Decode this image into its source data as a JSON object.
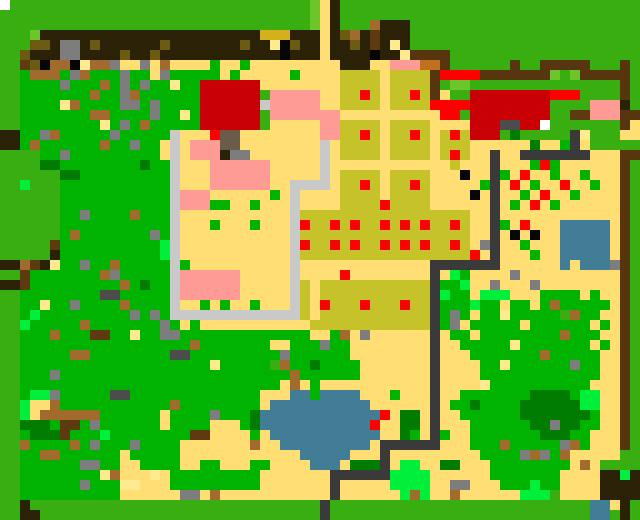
{
  "map": {
    "width_px": 640,
    "height_px": 520,
    "tile_size": 10,
    "cols": 64,
    "rows_count": 52,
    "palette": {
      "G": "#38ae11",
      "g": "#00b300",
      "D": "#007d00",
      "L": "#00ef3a",
      "M": "#6cc629",
      "Y": "#ffdf73",
      "y": "#ffeb8f",
      "O": "#c6c32a",
      "R": "#ff0000",
      "r": "#c80003",
      "P": "#ff9b95",
      "B": "#2b2106",
      "E": "#6b5b10",
      "T": "#d4b01b",
      "b": "#a26b2e",
      "h": "#5e3a10",
      "C": "#c1701f",
      "W": "#57350f",
      "K": "#060606",
      "k": "#3a3a3a",
      "A": "#4c4c4c",
      "S": "#7d7d7d",
      "s": "#c9c9c9",
      "U": "#417e96",
      "N": "#ffffff",
      "u": "#6b5b4b"
    },
    "palette_names": {
      "G": "grass-field",
      "g": "meadow-green",
      "D": "tree-canopy",
      "L": "lime-sprout",
      "M": "light-grass",
      "Y": "sand-dirt",
      "y": "pale-sand",
      "O": "crop-plot",
      "R": "red-crop",
      "r": "red-building",
      "P": "pink-terrace",
      "B": "dark-trunk",
      "E": "dark-olive",
      "T": "gold-tile",
      "b": "dirt-brown",
      "h": "deep-brown",
      "C": "orange-crate",
      "W": "fence-wood",
      "K": "black-tile",
      "k": "dark-trail",
      "A": "dark-stone",
      "S": "stone-gray",
      "s": "path-light",
      "U": "water",
      "N": "spawn-marker",
      "u": "gray-trunk"
    },
    "rows": [
      "NGGGGGGGGGGGGGGGGGGGGGGGGGGGGGGMYBGGGGGGGGGGGGGGGGGGGGGGGGGGGGGG",
      "GGGGGGGGGGGGGGGGGGGGGGGGGGGGGGGMYBGGGGGGGGGGGGGGGGGGGGGGGGGGGGGG",
      "GGGGGGGGGGGGGGGGGGGGGGGGGGGGGGGMYBGGGbBBBGGGGGGGGGGGGGGGGGGGGGGG",
      "GGGMBBBBBBBBBBBBBBBBBBBBBBTTTBBBYBEbBhBBBGGGGGGGGGGGGGGGGGGGGGGG",
      "GGGEEBSSBEBBBBBBEBBBBBBBEBByKEBBYBBEBhByBGGGGGGGGGGGGGGGGGGGGGGG",
      "GGEBBBSSBBBBEBBEBBBBBBBBBBBBKBBBYBBBBKBByWWWWGGGGGGGGGGGGGGGGGGG",
      "GGhEKbbKybbSYYSYbYYYYgYYgYYYYYYYYYBBBYYPPPCCWGGGGGGWGGWWWWWGGGWG",
      "GGgbbbgSbgggSggYSgggggYgYYYYYgYYYYOOOOYOOOOWRRRRWWWWWWWMGMWWWWWG",
      "GGggggSgggbgSgSggyggrrrrrrYYYYYYYYOOOOYOOOOWGMMGGGGGGGGGGGGGGGWG",
      "GGgggggggbggSbggggggrrrrrrGPPPPPYYOOROYOOROWYGGrrrrrrrrRRRGGGGWG",
      "GGggggybggggSSgSggggrrrrrrsPPPPPYYOOOOYOOOORRRRrrrrrrrrGGGGPPPBG",
      "GGgggggggbbggggSggygrrrrrrGPPPPPPPYYYYYYYYYYRRGrrrrrrrrGGhhPPPWW",
      "GGggggggggygSgbgggggrrrrrrGYYYYYPPOOOOYOOOOYYYYrrrAArrNGGGGGGGWY",
      "BBggSbgggggSgggggsYYYRuuYYYYYYYYPPOOROYOOROYOROrrrGDGGGGGkyGGGYY",
      "BBgbggggggbggSggYsYPPPuuYYYYYYYYsYOOOOYOOOOYOOOYYYYYYDYYgkYGGGGG",
      "GGGGggSgggggggggYsYPPPBSSYYYYYYYsYOOOOYOOOOYOROYYkYYkkkkkkkYYYWW",
      "GGGGDDggggggggDggsYYYPPPPPPYYYYYsYYYYYYYYYYYYOYYYkYYYgRgYYYYYYWG",
      "GGGGGGDDgggggggggsYYYPPPPPPYYYYYsYOOOOYOOOOYYYKYYkgYRYYgYYgYYYWG",
      "GGLGGGgggggggggggsYYYPPPPPPYYssssYOOROYOOROYYYYYgkYRYgYYRYYgYYWG",
      "GGGGGGgggggggggggsPPPYYYYYYgYsYYYYOOOOYOOOOYYYYKYkYYgYRYYgYYYYWG",
      "GGGGGGgggggggggggsPPPggYYgYYYsYYYYOOOOROOOOYYYYYYkYgYRYgYYYYYYWG",
      "GGGGGGggSggggbgggsYYYYYYYYYYYsOOOOOOOOOOOOOOOOOYYkYYYYYYYYYYYYWG",
      "GGGGGGgggggggggggsYYYgYYYgYYYsROOROROOROROROOROYYkgYRYYYUUUUUYWG",
      "GGGGGGgbgggggggSgsYYYYYYYYYYYsOOOOOOOOOOOOOOOOOYYkYKYKYYUUUUUYWG",
      "GGGGGhggggggggggLsYYYYYYYYYYYsROOROROOROROROOROYSkYYgYYYUUUUUYWG",
      "GGGGGBggggggggggLsYYYYYYYYYYYsOOOOOOOOOOOOOOOOORYkYYYgYYUUUUUYWG",
      "BBbhByggSggbgggggsgYYYYYYYYYYsYYYYYYYYYYYYYkkkkkkkYYYYYYUYUUUSWG",
      "GGhgggggggbSgggggsPPPPPPYYYYYsYYYYRYYYYYYYYkYLgYYYYSYYYYYYYYYYWG",
      "BBhgggggggggbgDggsPPPPPPYYYYYsOYOOOOOOOOOOOkggLYYSYYYSYYYYYYYYWG",
      "GGggggggggAAgggggsPPPPPPYYYYYsOYOOOOOOOOOOOkLggYLLLYYYggggYgYYWG",
      "GGggyggSggggbggggsYYgYgYYgYYYsOYROOOROOOROOkgggLggYggYgbgggggYWG",
      "GGgLgggggggggSgSgsssssssssssssOYOOOOOOOOOOOkgSgYggygggggగbggYYWG",
      "GGLgggggbgggggggSgYgYYYYYYYYYYYOOOOOOOOOOOOkgSYgggggYggggggYgYWG",
      "GGgggbggghhggyggSSgggggggggggggYYgbYSYYYYYYkYggYggggggggbgggYYWG",
      "GGgggggggggggggggggbgggggggYYgggSggYYYYYYYYkYYgggggygggggggYgYWG",
      "GGgggggbbggggggggAAgggggggggSggggggYYYYYYYYkYYYgggggggbgggggYYWG",
      "GGgggggggggggggggggggygggggגbggDggggYYYYYYYkYYYYggyggggggSggYYWG",
      "GGgggSgggggggggggggggggggggggbggggggYYYYYYYkYYYYggggggggggggYYWG",
      "GGggggggggggggggggggggggggggYbYgYYYYYYYYYYYkYYYYyggggggggggYYYWG",
      "GGgLLSgggggAAgggggggggggggYYYUUgUUUUYYYgYYYkYYgggggggDDDDgLLYYWG",
      "GGLYYbgggggggggggbggggggggYUUUUUUUUUUYYYYYYkYggDggggDDDDDDLLYYWG",
      "GGLYbbbbbbggggggYggggSgggDUUUUUUUUUUUURYDDYkYYggggggDDDDDDDgYYWG",
      "GGDDDghhgSggggggYggggYYYgDUUUUUUUUUUURYYDDYkYYYggggggDDSDDggYYWG",
      "GGgDDDhgggLgggggggghhYYYYgYUUUUUUUUUUUYYDgYkgYYgggggggDDDggYYYWG",
      "GGbggggbgSgggSggggYYYYYYYbYYUUUUUUUUUYkkkkkkYYYgggbgggggSbgYYYWG",
      "GGggbbggggggYgggggYYYYYYYYYYYYUUUUUYYYkYYYYYYYYYggggSbSgbYYYYYGG",
      "GGggggggSSggYYggggYYggYYYggYYYYUUUYDDDkYLLYYDDYYYggggggggYbYGGGG",
      "GGggggggggybYYYyYgggggggggYYYYYYYkkkkkkLLLLYYYYYYgggggggYYYYBBLB",
      "GGggggggSgggyyYYYgggggggggYYYYYYYkYYYYYLLLLYYSSYYYgggLggYYYYBBBB",
      "GGggggggggggYYYYYYSSYbYYYYYYYYYYYkYYYYYYLbLYYbYYYYYYLLLGYYYYBBBB",
      "GGBGGGGGGGGGGGGGGGGGGGGGGGGGGGGGkGGGGGGGGGGGGGGGGGGGGGGGGGGUUYB",
      "GGBBGGGGGGGGGGGGGGGGGGGGGGGGGGGGkGGGGGGGGGGGGGGGGGGGGGGGGGGUUGB"
    ],
    "features": [
      {
        "name": "spawn-marker",
        "col": 0,
        "row": 0,
        "w": 1,
        "h": 1
      },
      {
        "name": "red-barn",
        "col": 20,
        "row": 8,
        "w": 6,
        "h": 5
      },
      {
        "name": "red-stable",
        "col": 48,
        "row": 8,
        "w": 7,
        "h": 5
      },
      {
        "name": "animal-pen",
        "col": 54,
        "row": 6,
        "w": 5,
        "h": 2
      },
      {
        "name": "pink-terrace-north",
        "col": 27,
        "row": 9,
        "w": 7,
        "h": 3
      },
      {
        "name": "pink-terrace-east",
        "col": 59,
        "row": 10,
        "w": 3,
        "h": 2
      },
      {
        "name": "pink-terrace-yard",
        "col": 18,
        "row": 27,
        "w": 6,
        "h": 3
      },
      {
        "name": "crop-plot-a",
        "col": 34,
        "row": 7,
        "w": 4,
        "h": 4
      },
      {
        "name": "crop-plot-b",
        "col": 39,
        "row": 7,
        "w": 4,
        "h": 4
      },
      {
        "name": "crop-plot-c",
        "col": 34,
        "row": 12,
        "w": 4,
        "h": 4
      },
      {
        "name": "crop-plot-d",
        "col": 39,
        "row": 12,
        "w": 4,
        "h": 4
      },
      {
        "name": "crop-plot-e",
        "col": 34,
        "row": 17,
        "w": 4,
        "h": 4
      },
      {
        "name": "crop-plot-f",
        "col": 39,
        "row": 17,
        "w": 4,
        "h": 4
      },
      {
        "name": "crop-field-large",
        "col": 30,
        "row": 21,
        "w": 17,
        "h": 5
      },
      {
        "name": "crop-field-south",
        "col": 32,
        "row": 28,
        "w": 11,
        "h": 5
      },
      {
        "name": "pond-east",
        "col": 56,
        "row": 22,
        "w": 5,
        "h": 5
      },
      {
        "name": "pond-south",
        "col": 26,
        "row": 39,
        "w": 12,
        "h": 8
      },
      {
        "name": "homestead-path-outline",
        "col": 17,
        "row": 13,
        "w": 16,
        "h": 19
      },
      {
        "name": "dark-trail-upper",
        "col": 49,
        "row": 15,
        "w": 1,
        "h": 12
      },
      {
        "name": "dark-trail-cross",
        "col": 43,
        "row": 26,
        "w": 7,
        "h": 1
      },
      {
        "name": "dark-trail-vertical",
        "col": 43,
        "row": 26,
        "w": 1,
        "h": 19
      },
      {
        "name": "dark-trail-lower",
        "col": 33,
        "row": 44,
        "w": 11,
        "h": 6
      },
      {
        "name": "east-boundary-fence",
        "col": 62,
        "row": 6,
        "w": 1,
        "h": 39
      },
      {
        "name": "north-fence",
        "col": 44,
        "row": 7,
        "w": 18,
        "h": 1
      }
    ]
  }
}
